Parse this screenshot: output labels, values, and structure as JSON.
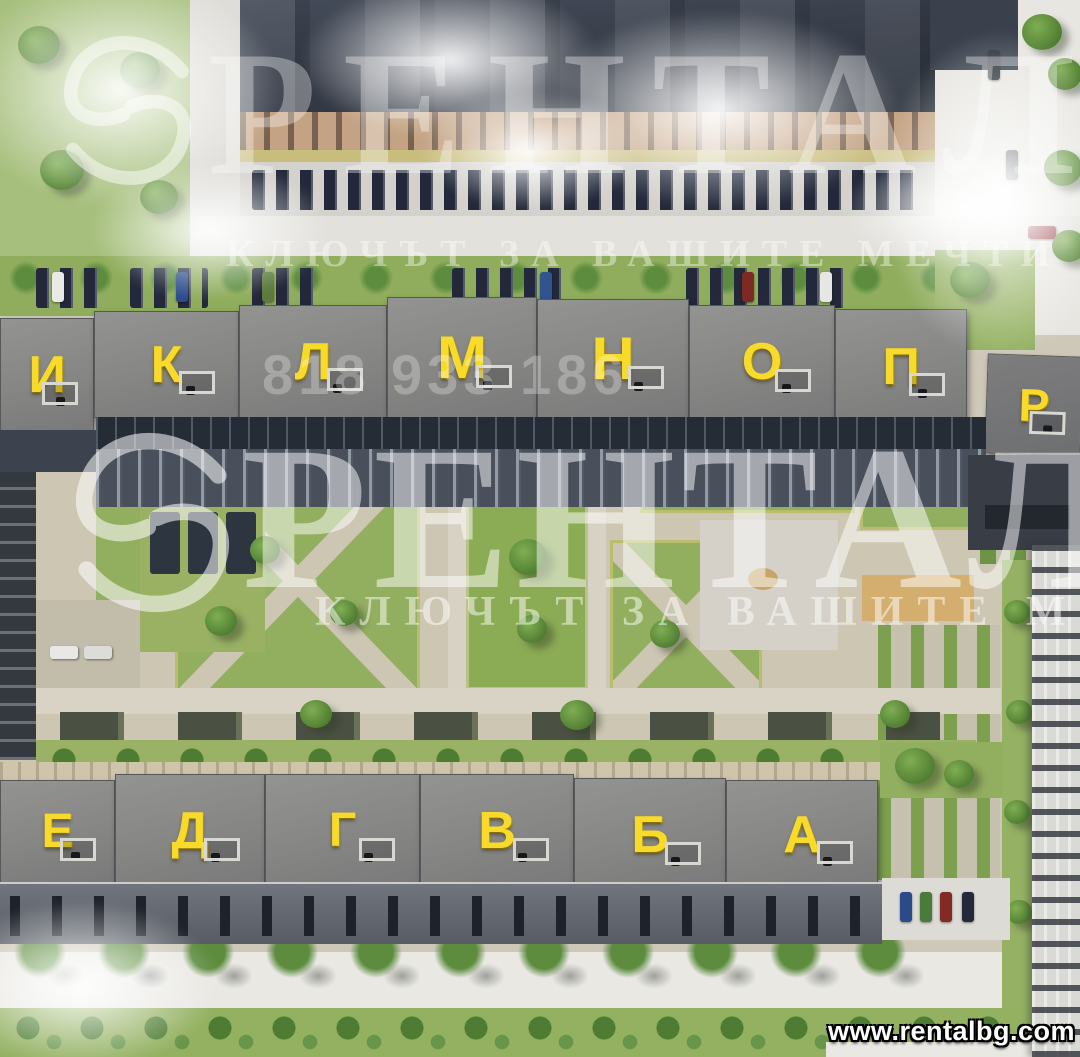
{
  "watermark": {
    "brand": "РЕНТАЛ",
    "tagline": "КЛЮЧЪТ ЗА ВАШИТЕ МЕЧТИ",
    "phone_fragment": "818 933 186",
    "logo": "s-swirl-circle-icon"
  },
  "website": "www.rentalbg.com",
  "buildings": {
    "north_row": [
      "И",
      "К",
      "Л",
      "М",
      "Н",
      "О",
      "П",
      "Р"
    ],
    "south_row": [
      "Е",
      "Д",
      "Г",
      "В",
      "Б",
      "А"
    ]
  },
  "palette": {
    "letter_yellow": "#f7da2a",
    "roof_gray": "#858583",
    "lawn_green": "#8fad5c",
    "facade_dark": "#3c434f",
    "watermark_white": "rgba(255,255,255,0.5)"
  }
}
